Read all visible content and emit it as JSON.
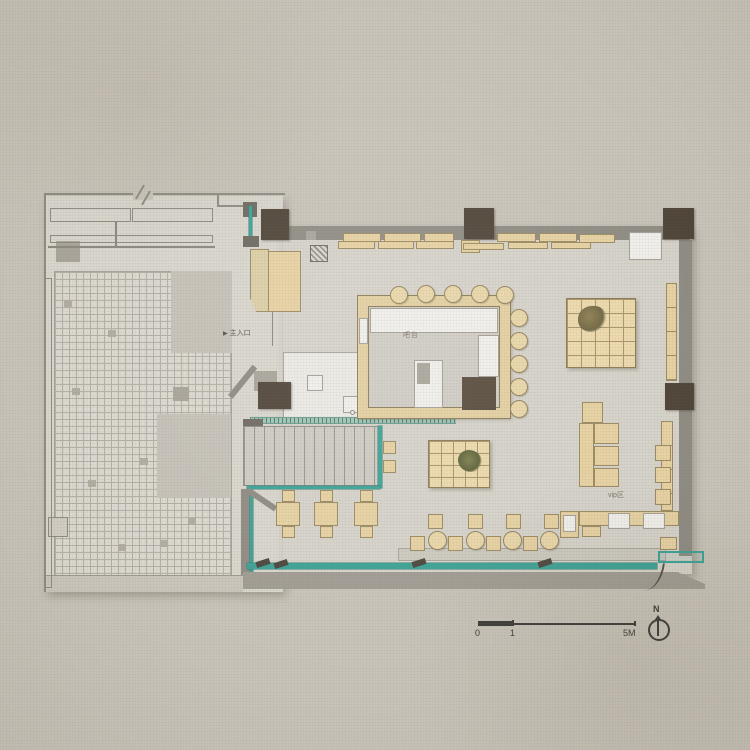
{
  "title": "restaurant floor plan",
  "labels": {
    "entrance": "主入口",
    "entrance_arrow": "▶",
    "bar": "吧台",
    "vip": "vip区",
    "north": "N",
    "scale_0": "0",
    "scale_1": "1",
    "scale_5m": "5M"
  },
  "colors": {
    "canvas": "#c8c3b9",
    "floor": "#d6d3cb",
    "wall": "#8e8b83",
    "column": "#4e4337",
    "wood": "#e6d1a1",
    "wood_border": "#9b8a61",
    "white_counter": "#f0efeb",
    "glass_teal": "#3aa294",
    "ink": "#3b3a37"
  },
  "shapes": [
    {
      "n": "site-floor-left",
      "c": "floorA",
      "r": [
        45,
        196,
        238,
        396
      ]
    },
    {
      "n": "indoor-floor",
      "c": "floorB",
      "r": [
        283,
        226,
        409,
        348
      ]
    },
    {
      "n": "courtyard-tiles",
      "c": "tiles",
      "r": [
        54,
        271,
        178,
        320
      ]
    },
    {
      "n": "courtyard-patch-1",
      "c": "patchgray",
      "r": [
        171,
        271,
        61,
        82
      ]
    },
    {
      "n": "courtyard-patch-2",
      "c": "patchgray",
      "r": [
        157,
        414,
        74,
        84
      ]
    },
    {
      "n": "tile-accent",
      "c": "tiledark",
      "r": [
        72,
        388,
        8,
        7
      ]
    },
    {
      "n": "tile-accent",
      "c": "tiledark",
      "r": [
        108,
        330,
        8,
        7
      ]
    },
    {
      "n": "tile-accent",
      "c": "tiledark",
      "r": [
        140,
        458,
        8,
        7
      ]
    },
    {
      "n": "tile-accent",
      "c": "tiledark",
      "r": [
        88,
        480,
        8,
        7
      ]
    },
    {
      "n": "tile-accent",
      "c": "tiledark",
      "r": [
        188,
        518,
        8,
        7
      ]
    },
    {
      "n": "tile-accent",
      "c": "tiledark",
      "r": [
        118,
        544,
        8,
        7
      ]
    },
    {
      "n": "tile-accent",
      "c": "tiledark",
      "r": [
        64,
        300,
        8,
        7
      ]
    },
    {
      "n": "tile-accent",
      "c": "tiledark",
      "r": [
        160,
        540,
        8,
        7
      ]
    },
    {
      "n": "courtyard-curb",
      "c": "curb",
      "r": [
        45,
        575,
        198,
        17
      ]
    },
    {
      "n": "planter",
      "c": "gray2",
      "r": [
        56,
        241,
        24,
        21
      ]
    },
    {
      "n": "planter",
      "c": "gray2",
      "r": [
        173,
        387,
        16,
        14
      ]
    },
    {
      "n": "planter",
      "c": "outline2",
      "r": [
        48,
        517,
        20,
        20
      ]
    },
    {
      "n": "left-fence",
      "c": "outline",
      "r": [
        45,
        278,
        7,
        310
      ]
    },
    {
      "n": "outdoor-bench",
      "c": "outline",
      "r": [
        50,
        208,
        81,
        14
      ]
    },
    {
      "n": "outdoor-bench",
      "c": "outline",
      "r": [
        132,
        208,
        81,
        14
      ]
    },
    {
      "n": "outdoor-bench",
      "c": "outline",
      "r": [
        50,
        235,
        163,
        8
      ]
    },
    {
      "n": "site-wall-top",
      "c": "wall",
      "r": [
        45,
        193,
        240,
        2
      ]
    },
    {
      "n": "site-wall-left",
      "c": "wall",
      "r": [
        44,
        193,
        2,
        399
      ]
    },
    {
      "n": "site-wall-step-v",
      "c": "wall",
      "r": [
        217,
        193,
        2,
        14
      ]
    },
    {
      "n": "site-wall-step-h",
      "c": "wall",
      "r": [
        217,
        205,
        30,
        2
      ]
    },
    {
      "n": "court-line-h",
      "c": "thinline",
      "r": [
        48,
        246,
        167,
        2
      ]
    },
    {
      "n": "court-line-v",
      "c": "thinline",
      "r": [
        115,
        222,
        2,
        25
      ]
    },
    {
      "n": "wall-break-gap",
      "c": "bg",
      "r": [
        133,
        184,
        20,
        16
      ]
    },
    {
      "n": "wall-break-line",
      "c": "wall",
      "r": [
        139,
        184,
        2,
        16
      ],
      "s": "transform:rotate(30deg);"
    },
    {
      "n": "wall-break-line",
      "c": "wall",
      "r": [
        145,
        190,
        2,
        16
      ],
      "s": "transform:rotate(30deg);"
    },
    {
      "n": "door-frame-top",
      "c": "darkwall",
      "r": [
        243,
        202,
        14,
        15
      ]
    },
    {
      "n": "door-glass",
      "c": "glass",
      "r": [
        249,
        206,
        3,
        34
      ]
    },
    {
      "n": "door-frame-bottom",
      "c": "darkwall",
      "r": [
        243,
        236,
        16,
        11
      ]
    },
    {
      "n": "top-wall",
      "c": "wall",
      "r": [
        286,
        226,
        404,
        14
      ]
    },
    {
      "n": "right-wall",
      "c": "wall",
      "r": [
        679,
        240,
        13,
        316
      ]
    },
    {
      "n": "column",
      "c": "col",
      "r": [
        261,
        209,
        28,
        31
      ]
    },
    {
      "n": "column",
      "c": "col",
      "r": [
        464,
        208,
        30,
        31
      ]
    },
    {
      "n": "column",
      "c": "col",
      "r": [
        663,
        208,
        31,
        31
      ]
    },
    {
      "n": "column",
      "c": "col",
      "r": [
        665,
        383,
        29,
        27
      ]
    },
    {
      "n": "wall-bench",
      "c": "woodb",
      "r": [
        343,
        233,
        38,
        9
      ]
    },
    {
      "n": "wall-bench",
      "c": "woodb",
      "r": [
        384,
        233,
        37,
        9
      ]
    },
    {
      "n": "wall-bench",
      "c": "woodb",
      "r": [
        424,
        233,
        30,
        9
      ]
    },
    {
      "n": "wall-bench",
      "c": "woodb",
      "r": [
        338,
        241,
        37,
        8
      ]
    },
    {
      "n": "wall-bench",
      "c": "woodb",
      "r": [
        378,
        241,
        36,
        8
      ]
    },
    {
      "n": "wall-bench",
      "c": "woodb",
      "r": [
        416,
        241,
        38,
        8
      ]
    },
    {
      "n": "wall-bench",
      "c": "woodb",
      "r": [
        461,
        240,
        19,
        13
      ]
    },
    {
      "n": "wall-bench",
      "c": "woodb",
      "r": [
        497,
        233,
        39,
        9
      ]
    },
    {
      "n": "wall-bench",
      "c": "woodb",
      "r": [
        539,
        233,
        38,
        9
      ]
    },
    {
      "n": "wall-bench",
      "c": "woodb",
      "r": [
        579,
        234,
        36,
        9
      ]
    },
    {
      "n": "wall-bench",
      "c": "woodb",
      "r": [
        463,
        243,
        41,
        7
      ]
    },
    {
      "n": "wall-bench",
      "c": "woodb",
      "r": [
        508,
        242,
        40,
        7
      ]
    },
    {
      "n": "wall-bench",
      "c": "woodb",
      "r": [
        551,
        242,
        40,
        7
      ]
    },
    {
      "n": "service-box",
      "c": "white",
      "r": [
        629,
        232,
        33,
        28
      ]
    },
    {
      "n": "right-shelf",
      "c": "woodseg",
      "r": [
        666,
        283,
        11,
        98
      ]
    },
    {
      "n": "equipment-small",
      "c": "gray2",
      "r": [
        306,
        231,
        10,
        9
      ]
    },
    {
      "n": "host-stand",
      "c": "hatch",
      "r": [
        310,
        245,
        18,
        17
      ]
    },
    {
      "n": "entry-cabinet-left",
      "c": "woodlite",
      "r": [
        250,
        249,
        19,
        63
      ]
    },
    {
      "n": "entry-cabinet-right",
      "c": "woodb",
      "r": [
        268,
        251,
        33,
        61
      ]
    },
    {
      "n": "door-swing-line",
      "c": "thinline",
      "r": [
        272,
        312,
        1,
        34
      ]
    },
    {
      "n": "kitchen-floor",
      "c": "white2",
      "r": [
        283,
        352,
        177,
        66
      ]
    },
    {
      "n": "kitchen-box",
      "c": "white",
      "r": [
        307,
        375,
        16,
        16
      ]
    },
    {
      "n": "sink",
      "c": "white",
      "r": [
        343,
        396,
        20,
        17
      ]
    },
    {
      "n": "sink",
      "c": "white",
      "r": [
        363,
        396,
        20,
        17
      ]
    },
    {
      "n": "faucet",
      "c": "dot",
      "r": [
        350,
        410,
        5,
        5
      ]
    },
    {
      "n": "faucet",
      "c": "dot",
      "r": [
        370,
        410,
        5,
        5
      ]
    },
    {
      "n": "glass-partition",
      "c": "glasshatch",
      "r": [
        250,
        417,
        206,
        7
      ]
    },
    {
      "n": "duct",
      "c": "gray2",
      "r": [
        254,
        371,
        23,
        20
      ]
    },
    {
      "n": "column",
      "c": "col",
      "r": [
        258,
        382,
        33,
        27
      ]
    },
    {
      "n": "vestibule-diag-wall",
      "c": "wall",
      "r": [
        228,
        395,
        39,
        6
      ],
      "s": "transform:rotate(-51deg);transform-origin:0 0;"
    },
    {
      "n": "vestibule-bar",
      "c": "darkwall",
      "r": [
        243,
        419,
        20,
        8
      ]
    },
    {
      "n": "stairs",
      "c": "stairs",
      "r": [
        243,
        426,
        137,
        60
      ]
    },
    {
      "n": "stairs-glass-right",
      "c": "glass",
      "r": [
        378,
        426,
        4,
        62
      ]
    },
    {
      "n": "stairs-glass-bottom",
      "c": "glass",
      "r": [
        247,
        486,
        133,
        3
      ]
    },
    {
      "n": "left-wall-low",
      "c": "wall",
      "r": [
        241,
        489,
        9,
        86
      ]
    },
    {
      "n": "left-glass-low",
      "c": "glass",
      "r": [
        250,
        492,
        3,
        82
      ]
    },
    {
      "n": "seating-diag-wall",
      "c": "wall",
      "r": [
        250,
        488,
        33,
        6
      ],
      "s": "transform:rotate(34deg);transform-origin:0 0;"
    },
    {
      "n": "bar-counter-ring",
      "c": "ring",
      "r": [
        358,
        296,
        152,
        122
      ]
    },
    {
      "n": "bar-counter-top",
      "c": "white",
      "r": [
        370,
        308,
        128,
        25
      ]
    },
    {
      "n": "bar-counter-right",
      "c": "white",
      "r": [
        478,
        335,
        21,
        42
      ]
    },
    {
      "n": "bar-island",
      "c": "white",
      "r": [
        414,
        360,
        29,
        48
      ]
    },
    {
      "n": "bar-equipment",
      "c": "dark2",
      "r": [
        462,
        377,
        34,
        33
      ]
    },
    {
      "n": "bar-appliance",
      "c": "gray2",
      "r": [
        417,
        363,
        13,
        21
      ]
    },
    {
      "n": "bar-side-unit",
      "c": "white",
      "r": [
        359,
        318,
        9,
        26
      ]
    },
    {
      "n": "bar-stool",
      "c": "stool",
      "r": [
        390,
        286,
        18,
        18
      ]
    },
    {
      "n": "bar-stool",
      "c": "stool",
      "r": [
        417,
        285,
        18,
        18
      ]
    },
    {
      "n": "bar-stool",
      "c": "stool",
      "r": [
        444,
        285,
        18,
        18
      ]
    },
    {
      "n": "bar-stool",
      "c": "stool",
      "r": [
        471,
        285,
        18,
        18
      ]
    },
    {
      "n": "bar-stool",
      "c": "stool",
      "r": [
        496,
        286,
        18,
        18
      ]
    },
    {
      "n": "bar-stool",
      "c": "stool",
      "r": [
        510,
        309,
        18,
        18
      ]
    },
    {
      "n": "bar-stool",
      "c": "stool",
      "r": [
        510,
        332,
        18,
        18
      ]
    },
    {
      "n": "bar-stool",
      "c": "stool",
      "r": [
        510,
        355,
        18,
        18
      ]
    },
    {
      "n": "bar-stool",
      "c": "stool",
      "r": [
        510,
        378,
        18,
        18
      ]
    },
    {
      "n": "bar-stool",
      "c": "stool",
      "r": [
        510,
        400,
        18,
        18
      ]
    },
    {
      "n": "tatami-platform",
      "c": "tatami",
      "r": [
        566,
        298,
        70,
        70
      ],
      "s": "--cell:14px;"
    },
    {
      "n": "plant",
      "c": "plant",
      "r": [
        578,
        306,
        28,
        26
      ]
    },
    {
      "n": "tatami-platform",
      "c": "tatami",
      "r": [
        428,
        440,
        62,
        48
      ],
      "s": "--cell:12px;"
    },
    {
      "n": "plant",
      "c": "plant2",
      "r": [
        458,
        450,
        24,
        22
      ]
    },
    {
      "n": "stool-square",
      "c": "woodb",
      "r": [
        383,
        441,
        13,
        13
      ]
    },
    {
      "n": "stool-square",
      "c": "woodb",
      "r": [
        383,
        460,
        13,
        13
      ]
    },
    {
      "n": "chair",
      "c": "woodb",
      "r": [
        282,
        490,
        13,
        12
      ]
    },
    {
      "n": "table",
      "c": "woodb",
      "r": [
        276,
        502,
        24,
        24
      ]
    },
    {
      "n": "chair",
      "c": "woodb",
      "r": [
        282,
        526,
        13,
        12
      ]
    },
    {
      "n": "chair",
      "c": "woodb",
      "r": [
        320,
        490,
        13,
        12
      ]
    },
    {
      "n": "table",
      "c": "woodb",
      "r": [
        314,
        502,
        24,
        24
      ]
    },
    {
      "n": "chair",
      "c": "woodb",
      "r": [
        320,
        526,
        13,
        12
      ]
    },
    {
      "n": "chair",
      "c": "woodb",
      "r": [
        360,
        490,
        13,
        12
      ]
    },
    {
      "n": "table",
      "c": "woodb",
      "r": [
        354,
        502,
        24,
        24
      ]
    },
    {
      "n": "chair",
      "c": "woodb",
      "r": [
        360,
        526,
        13,
        12
      ]
    },
    {
      "n": "window-ledge",
      "c": "curb2",
      "r": [
        398,
        548,
        268,
        13
      ]
    },
    {
      "n": "stool-square",
      "c": "woodb",
      "r": [
        428,
        514,
        15,
        15
      ]
    },
    {
      "n": "stool-square",
      "c": "woodb",
      "r": [
        468,
        514,
        15,
        15
      ]
    },
    {
      "n": "stool-square",
      "c": "woodb",
      "r": [
        506,
        514,
        15,
        15
      ]
    },
    {
      "n": "stool-square",
      "c": "woodb",
      "r": [
        544,
        514,
        15,
        15
      ]
    },
    {
      "n": "stool-square",
      "c": "woodb",
      "r": [
        410,
        536,
        15,
        15
      ]
    },
    {
      "n": "stool-square",
      "c": "woodb",
      "r": [
        448,
        536,
        15,
        15
      ]
    },
    {
      "n": "stool-square",
      "c": "woodb",
      "r": [
        486,
        536,
        15,
        15
      ]
    },
    {
      "n": "stool-square",
      "c": "woodb",
      "r": [
        523,
        536,
        15,
        15
      ]
    },
    {
      "n": "round-table",
      "c": "stool",
      "r": [
        428,
        531,
        19,
        19
      ]
    },
    {
      "n": "round-table",
      "c": "stool",
      "r": [
        466,
        531,
        19,
        19
      ]
    },
    {
      "n": "round-table",
      "c": "stool",
      "r": [
        503,
        531,
        19,
        19
      ]
    },
    {
      "n": "round-table",
      "c": "stool",
      "r": [
        540,
        531,
        19,
        19
      ]
    },
    {
      "n": "vip-sofa",
      "c": "woodb",
      "r": [
        582,
        402,
        21,
        21
      ]
    },
    {
      "n": "vip-sofa",
      "c": "woodb",
      "r": [
        579,
        423,
        15,
        64
      ]
    },
    {
      "n": "vip-sofa",
      "c": "woodb",
      "r": [
        594,
        423,
        25,
        21
      ]
    },
    {
      "n": "vip-sofa",
      "c": "woodb",
      "r": [
        594,
        446,
        25,
        20
      ]
    },
    {
      "n": "vip-sofa",
      "c": "woodb",
      "r": [
        594,
        468,
        25,
        19
      ]
    },
    {
      "n": "vip-wall-bench",
      "c": "woodseg",
      "r": [
        661,
        421,
        12,
        90
      ]
    },
    {
      "n": "vip-cushion",
      "c": "woodb",
      "r": [
        655,
        445,
        16,
        16
      ]
    },
    {
      "n": "vip-cushion",
      "c": "woodb",
      "r": [
        655,
        467,
        16,
        16
      ]
    },
    {
      "n": "vip-cushion",
      "c": "woodb",
      "r": [
        655,
        489,
        16,
        16
      ]
    },
    {
      "n": "vip-counter-block",
      "c": "woodb",
      "r": [
        560,
        511,
        19,
        27
      ]
    },
    {
      "n": "vip-counter-white",
      "c": "white",
      "r": [
        563,
        515,
        13,
        17
      ]
    },
    {
      "n": "vip-counter",
      "c": "woodb",
      "r": [
        579,
        511,
        100,
        15
      ]
    },
    {
      "n": "vip-counter-white",
      "c": "white",
      "r": [
        608,
        513,
        22,
        16
      ]
    },
    {
      "n": "vip-counter-white",
      "c": "white",
      "r": [
        643,
        513,
        22,
        16
      ]
    },
    {
      "n": "vip-counter-step",
      "c": "woodb",
      "r": [
        582,
        526,
        19,
        11
      ]
    },
    {
      "n": "vip-side-table",
      "c": "woodb",
      "r": [
        660,
        537,
        17,
        13
      ]
    },
    {
      "n": "glass-wall-bottom",
      "c": "glass",
      "r": [
        247,
        563,
        410,
        6
      ]
    },
    {
      "n": "glass-mullion",
      "c": "tick",
      "r": [
        256,
        560,
        14,
        6
      ]
    },
    {
      "n": "glass-mullion",
      "c": "tick",
      "r": [
        274,
        561,
        14,
        6
      ]
    },
    {
      "n": "glass-mullion",
      "c": "tick",
      "r": [
        412,
        560,
        14,
        6
      ]
    },
    {
      "n": "glass-mullion",
      "c": "tick",
      "r": [
        538,
        560,
        14,
        6
      ]
    },
    {
      "n": "glass-wall-corner",
      "c": "glassoutline",
      "r": [
        658,
        551,
        46,
        12
      ]
    },
    {
      "n": "bottom-sill",
      "c": "sill",
      "r": [
        243,
        572,
        462,
        17
      ]
    },
    {
      "n": "drain-curve",
      "c": "curve",
      "r": [
        645,
        562,
        18,
        30
      ],
      "s": "transform:rotate(8deg);"
    }
  ]
}
